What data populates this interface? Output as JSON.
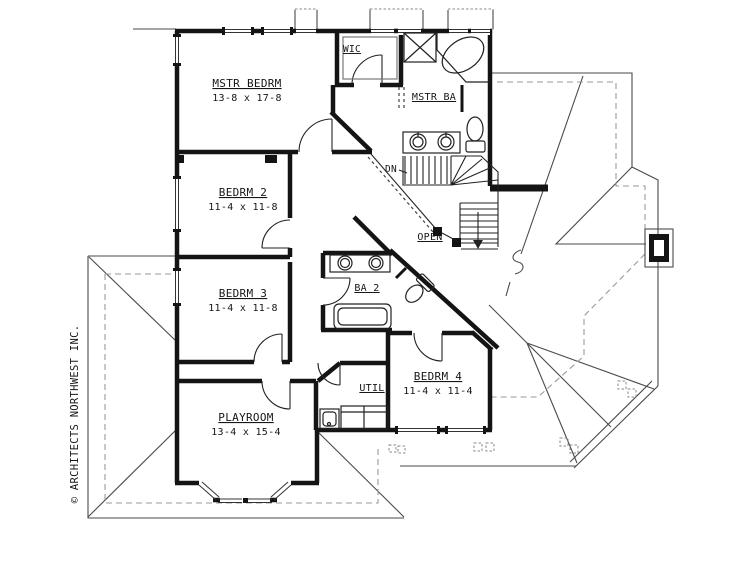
{
  "document": {
    "type": "architectural-floor-plan",
    "floor": "second-floor"
  },
  "copyright": "© ARCHITECTS NORTHWEST INC.",
  "rooms": {
    "master_bedroom": {
      "name": "MSTR BEDRM",
      "dims": "13-8 x 17-8"
    },
    "wic": {
      "name": "WIC"
    },
    "master_bath": {
      "name": "MSTR BA"
    },
    "bedroom2": {
      "name": "BEDRM 2",
      "dims": "11-4 x 11-8"
    },
    "bedroom3": {
      "name": "BEDRM 3",
      "dims": "11-4 x 11-8"
    },
    "bath2": {
      "name": "BA 2"
    },
    "bedroom4": {
      "name": "BEDRM 4",
      "dims": "11-4 x 11-4"
    },
    "utility": {
      "name": "UTIL"
    },
    "playroom": {
      "name": "PLAYROOM",
      "dims": "13-4 x 15-4"
    }
  },
  "annotations": {
    "down": "DN",
    "open": "OPEN"
  },
  "colors": {
    "background": "#ffffff",
    "wall": "#141414",
    "thin_line": "#222222",
    "roof_line": "#4a4a4a",
    "eave_dashed": "#9a9a9a"
  }
}
